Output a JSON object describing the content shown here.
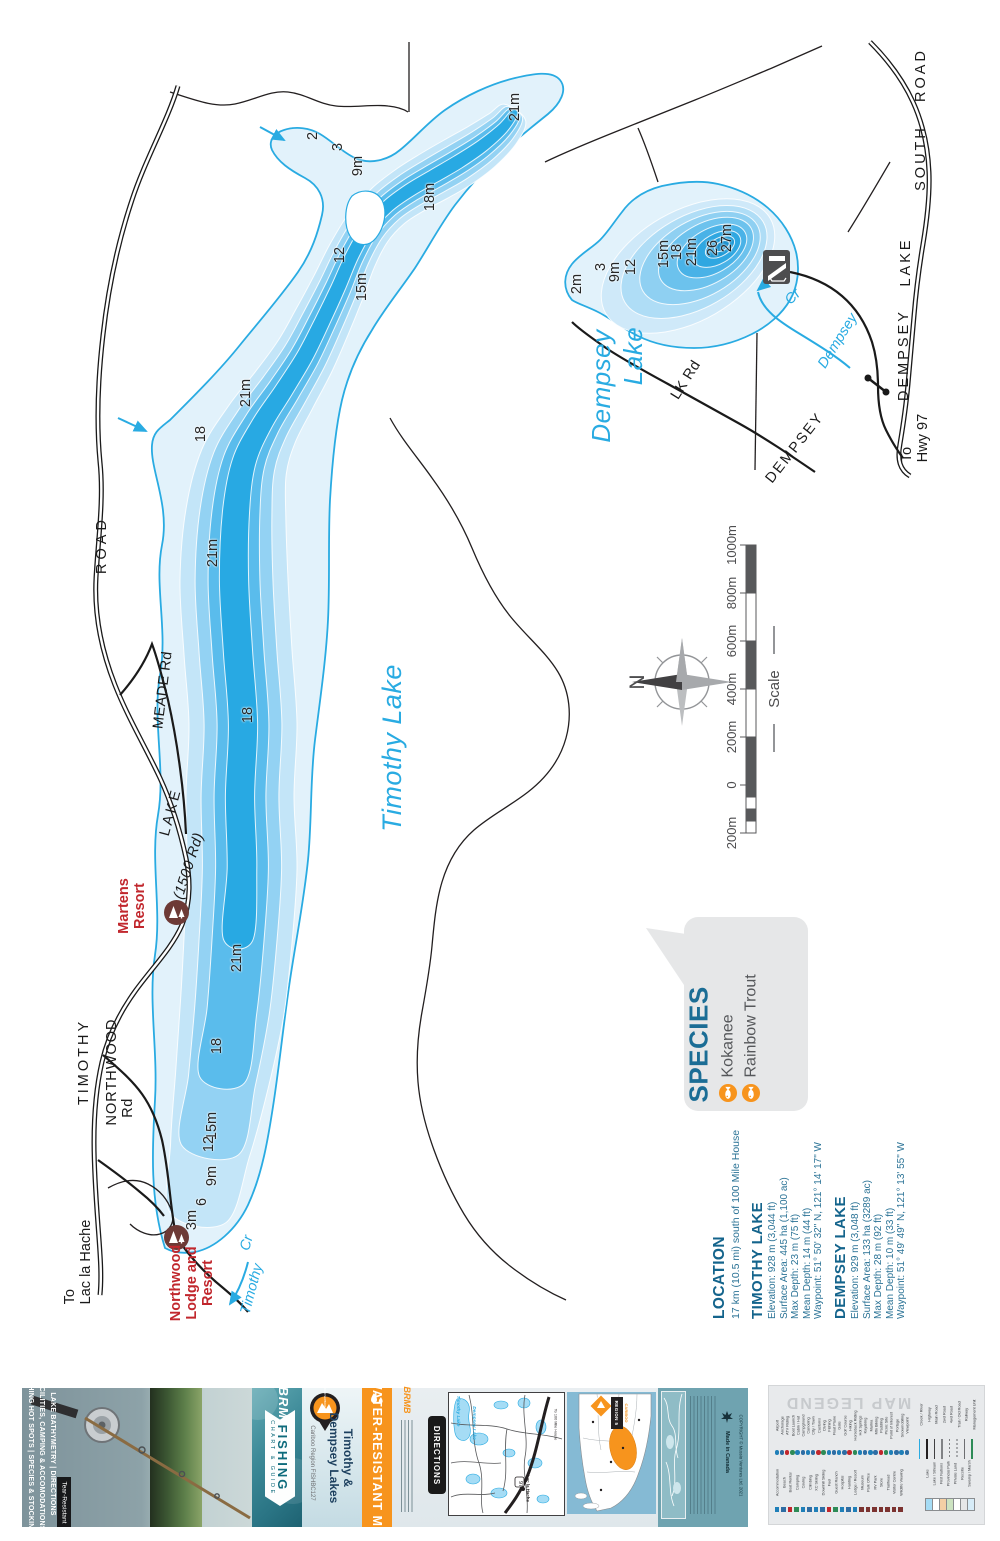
{
  "map": {
    "lake_name_labels": [
      {
        "t": "Timothy Lake",
        "x": 392,
        "y": 748,
        "a": -90,
        "s": 27
      },
      {
        "t": "Dempsey",
        "x": 601,
        "y": 386,
        "a": -90,
        "s": 26
      },
      {
        "t": "Lake",
        "x": 633,
        "y": 356,
        "a": -90,
        "s": 26
      }
    ],
    "depth_labels": [
      {
        "t": "2",
        "x": 313,
        "y": 136
      },
      {
        "t": "3",
        "x": 338,
        "y": 147
      },
      {
        "t": "9m",
        "x": 358,
        "y": 166
      },
      {
        "t": "18m",
        "x": 430,
        "y": 197
      },
      {
        "t": "12",
        "x": 340,
        "y": 255
      },
      {
        "t": "15m",
        "x": 362,
        "y": 287
      },
      {
        "t": "21m",
        "x": 515,
        "y": 107
      },
      {
        "t": "21m",
        "x": 246,
        "y": 393
      },
      {
        "t": "18",
        "x": 201,
        "y": 434
      },
      {
        "t": "21m",
        "x": 213,
        "y": 553
      },
      {
        "t": "18",
        "x": 248,
        "y": 715
      },
      {
        "t": "21m",
        "x": 237,
        "y": 958
      },
      {
        "t": "18",
        "x": 217,
        "y": 1046
      },
      {
        "t": "15m",
        "x": 212,
        "y": 1126
      },
      {
        "t": "12",
        "x": 209,
        "y": 1144
      },
      {
        "t": "9m",
        "x": 212,
        "y": 1176
      },
      {
        "t": "6",
        "x": 202,
        "y": 1202
      },
      {
        "t": "3m",
        "x": 192,
        "y": 1220
      },
      {
        "t": "2m",
        "x": 577,
        "y": 284
      },
      {
        "t": "3",
        "x": 601,
        "y": 267
      },
      {
        "t": "9m",
        "x": 615,
        "y": 272
      },
      {
        "t": "12",
        "x": 631,
        "y": 267
      },
      {
        "t": "15m",
        "x": 664,
        "y": 254
      },
      {
        "t": "18",
        "x": 677,
        "y": 252
      },
      {
        "t": "21m",
        "x": 692,
        "y": 252
      },
      {
        "t": "26",
        "x": 713,
        "y": 248
      },
      {
        "t": "27m",
        "x": 727,
        "y": 238
      }
    ],
    "road_labels": [
      {
        "t": "ROAD",
        "x": 102,
        "y": 545,
        "a": -90,
        "ls": 4
      },
      {
        "t": "MEADE Rd",
        "x": 163,
        "y": 690,
        "a": -83,
        "ls": 0.5
      },
      {
        "t": "LAKE",
        "x": 171,
        "y": 812,
        "a": -75,
        "ls": 3
      },
      {
        "t": "(1500 Rd)",
        "x": 189,
        "y": 866,
        "a": -72,
        "ls": 0.5,
        "i": 1
      },
      {
        "t": "TIMOTHY",
        "x": 84,
        "y": 1062,
        "a": -90,
        "ls": 3
      },
      {
        "t": "NORTHWOOD",
        "x": 112,
        "y": 1072,
        "a": -90,
        "ls": 1
      },
      {
        "t": "Rd",
        "x": 128,
        "y": 1108,
        "a": -90,
        "ls": 0.5
      },
      {
        "t": "ROAD",
        "x": 921,
        "y": 75,
        "a": -90,
        "ls": 3
      },
      {
        "t": "SOUTH",
        "x": 921,
        "y": 158,
        "a": -90,
        "ls": 3
      },
      {
        "t": "LAKE",
        "x": 906,
        "y": 262,
        "a": -90,
        "ls": 3
      },
      {
        "t": "DEMPSEY",
        "x": 904,
        "y": 355,
        "a": -90,
        "ls": 3
      },
      {
        "t": "DEMPSEY",
        "x": 795,
        "y": 448,
        "a": -52,
        "ls": 2
      },
      {
        "t": "LK Rd",
        "x": 686,
        "y": 380,
        "a": -58,
        "ls": 0.5
      }
    ],
    "dest_labels": [
      {
        "t": "To\nLac la Hache",
        "x": 78,
        "y": 1262,
        "a": -90
      },
      {
        "t": "To\nHwy 97",
        "x": 915,
        "y": 438,
        "a": -90
      }
    ],
    "creek_labels": [
      {
        "t": "Timothy",
        "x": 252,
        "y": 1289,
        "a": -75
      },
      {
        "t": "Cr",
        "x": 247,
        "y": 1243,
        "a": -75
      },
      {
        "t": "Dempsey",
        "x": 838,
        "y": 341,
        "a": -58
      },
      {
        "t": "Cr",
        "x": 793,
        "y": 297,
        "a": -45
      }
    ],
    "resorts": [
      {
        "t": "Martens\nResort",
        "x": 133,
        "y": 906,
        "icon_x": 176,
        "icon_y": 912
      },
      {
        "t": "Northwood\nLodge and\nResort",
        "x": 193,
        "y": 1283,
        "icon_x": 176,
        "icon_y": 1237
      }
    ],
    "compass_n": "N",
    "scale": {
      "title": "Scale",
      "labels": [
        {
          "t": "200m",
          "y": 833
        },
        {
          "t": "0",
          "y": 785
        },
        {
          "t": "200m",
          "y": 737
        },
        {
          "t": "400m",
          "y": 689
        },
        {
          "t": "600m",
          "y": 641
        },
        {
          "t": "800m",
          "y": 593
        },
        {
          "t": "1000m",
          "y": 545
        }
      ]
    },
    "species": {
      "title": "SPECIES",
      "items": [
        "Kokanee",
        "Rainbow Trout"
      ]
    },
    "location": {
      "title": "LOCATION",
      "subtitle": "17 km (10.5 mi) south of 100 Mile House",
      "lakes": [
        {
          "name": "TIMOTHY LAKE",
          "lines": [
            "Elevation: 928 m (3,044 ft)",
            "Surface Area: 445 ha (1,100 ac)",
            "Max Depth: 23 m (75 ft)",
            "Mean Depth: 14 m (44 ft)",
            "Waypoint: 51° 50' 32\" N, 121° 14' 17\" W"
          ]
        },
        {
          "name": "DEMPSEY LAKE",
          "lines": [
            "Elevation: 929 m (3,048 ft)",
            "Surface Area: 133 ha (3289 ac)",
            "Max Depth: 28 m (92 ft)",
            "Mean Depth: 10 m (33 ft)",
            "Waypoint: 51° 49' 49\" N, 121° 13' 55\" W"
          ]
        }
      ]
    },
    "colors": {
      "shore": "#29abe2",
      "deep": "#28a9e3",
      "red": "#c1272d",
      "header_blue": "#14648c",
      "orange": "#f7941d"
    }
  },
  "footer": {
    "cover": {
      "tagline_lines": [
        "FISHING HOT SPOTS | SPECIES & STOCKING",
        "FACILITIES, CAMPING & ACCOMODATIONS",
        "LAKE BATHYMETRY | DIRECTIONS"
      ],
      "tear_resistant": "Tear-Resistant",
      "brand": "BRMB",
      "chart_label": "FISHING",
      "chart_sublabel": "CHART & GUIDE"
    },
    "title_panel": {
      "title": "Timothy &\nDempsey Lakes",
      "region": "Cariboo Region FISHBC127",
      "logo_ring": "BACKROAD MAPBOOKS"
    },
    "banner": {
      "text": "WATER-RESISTANT MAP"
    },
    "directions": {
      "tab": "DIRECTIONS",
      "brand": "BRMB",
      "inset_labels": {
        "lake1": "Timothy Lake",
        "lake2": "Dempsey Lake",
        "town": "Lac la Hache",
        "hwy": "97",
        "dest": "To 100 Mile House"
      },
      "region_badge": {
        "line1": "REGION 5",
        "line2": "CARIBOO"
      }
    },
    "copyright": {
      "made_in": "Made in Canada",
      "line": "COPYRIGHT © Mussio Ventures Ltd. 2021"
    },
    "legend": {
      "title": "MAP LEGEND",
      "groups": [
        {
          "name": "activities",
          "items": [
            "Airport",
            "Anchorage",
            "ATV Riding",
            "Boat Launch",
            "Cabin / Hut",
            "Campground",
            "Canoeing",
            "City / Town",
            "Customs",
            "Diving",
            "Fishing",
            "Float Plane",
            "Gate",
            "Golf Course",
            "Hiking",
            "Horseback Riding",
            "Hot Springs",
            "Kayaking",
            "Marina",
            "Mtn Biking",
            "Paddling",
            "Picnic Site",
            "Point of Interest",
            "Portage",
            "Snowmobiling",
            "Viewpoint"
          ]
        },
        {
          "name": "services",
          "items": [
            "Accommodation",
            "Beach",
            "Boat Rental",
            "Camping",
            "Caving",
            "Climbing",
            "XC Skiing",
            "Downhill Skiing",
            "Fuel",
            "Guest Ranch",
            "Hospital",
            "Hunting",
            "Lodge / Resort",
            "Museum",
            "Park Office",
            "RV Park",
            "Store",
            "Trailhead",
            "Visitor Centre",
            "Wildlife Viewing"
          ]
        },
        {
          "name": "lines",
          "items": [
            "Creek / River",
            "Highway",
            "Main Road",
            "2wd Road",
            "4wd Road",
            "Trail / Old Road",
            "Railway",
            "Management Unit"
          ]
        },
        {
          "name": "areas",
          "items": [
            "Lake",
            "Lake / Stream",
            "First Nations",
            "Provincial Park",
            "Private Land",
            "Recsite",
            "Swamp / Marsh"
          ]
        }
      ]
    }
  }
}
